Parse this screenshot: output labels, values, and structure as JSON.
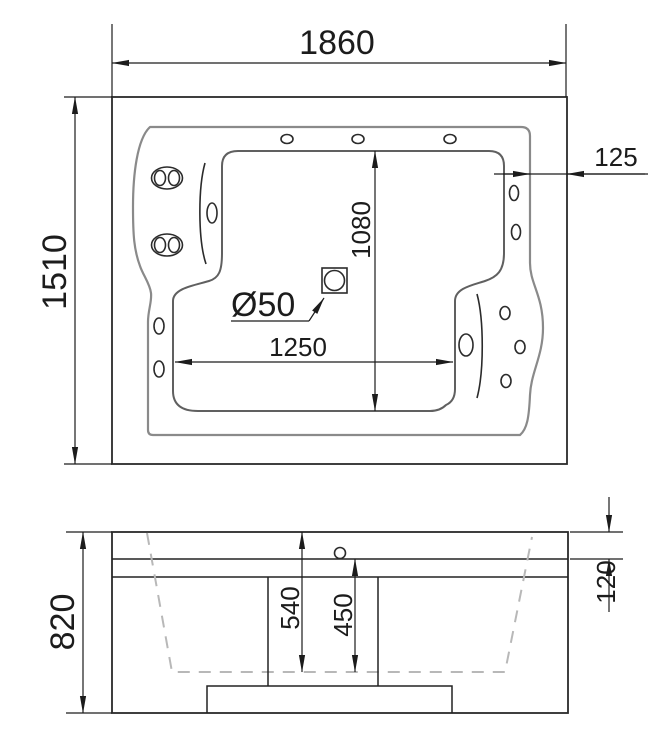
{
  "colors": {
    "line": "#1c1c1c",
    "rim_outline": "#8a8a8a",
    "basin_outline": "#606060",
    "hidden_profile": "#b8b8b8",
    "background": "#ffffff"
  },
  "top_view": {
    "overall_length": "1860",
    "overall_width": "1510",
    "edge_offset": "125",
    "basin_width": "1080",
    "basin_length": "1250",
    "drain_diameter": "Ø50"
  },
  "side_view": {
    "overall_height": "820",
    "rim_band_height": "120",
    "depth_from_top": "540",
    "basin_depth": "450"
  }
}
